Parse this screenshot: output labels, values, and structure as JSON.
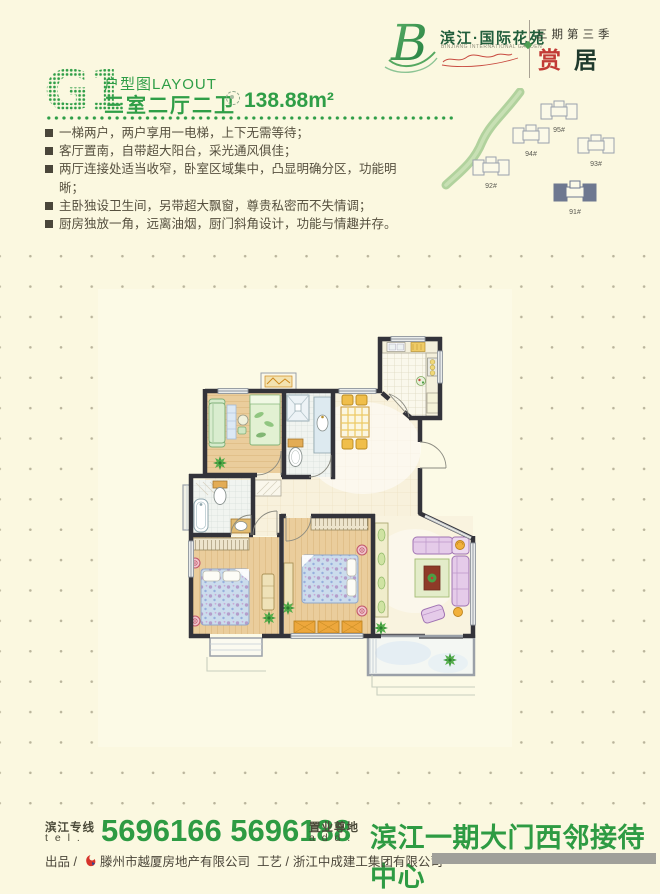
{
  "logo": {
    "monogram": "B",
    "name_cn": "滨江·国际花苑",
    "name_en": "BINJIANG INTERNATIONAL GARDEN",
    "phase_label": "三期第三季",
    "phase_char_1": "赏",
    "phase_char_2": "居"
  },
  "header": {
    "unit_code": "G1",
    "layout_label": "户型图LAYOUT",
    "rooms_label": "三室二厅二卫",
    "area_value": "138.88m²"
  },
  "features": [
    "一梯两户，两户享用一电梯，上下无需等待；",
    "客厅置南，自带超大阳台，采光通风俱佳；",
    "两厅连接处适当收窄，卧室区域集中，凸显明确分区，功能明晰；",
    "主卧独设卫生间，另带超大飘窗，尊贵私密而不失情调；",
    "厨房独放一角，远离油烟，厨门斜角设计，功能与情趣并存。"
  ],
  "site_plan": {
    "building_labels": [
      "95#",
      "94#",
      "93#",
      "92#",
      "91#"
    ],
    "highlighted": "91#"
  },
  "contact": {
    "tel_label_cn": "滨江专线",
    "tel_label_en": "t e l .",
    "phone_numbers": "5696166 5696188",
    "addr_label_cn": "置业尊地",
    "addr_label_en": "a d d .",
    "address": "滨江一期大门西邻接待中心"
  },
  "credits": {
    "producer_prefix": "出品 /",
    "producer": "滕州市越厦房地产有限公司",
    "craft_prefix": "工艺 /",
    "builder": "浙江中成建工集团有限公司"
  },
  "colors": {
    "accent_green": "#2F9E47",
    "logo_green": "#215E3C",
    "accent_red": "#C23B36",
    "text_dark": "#56503F",
    "background": "#FBF8E0"
  }
}
